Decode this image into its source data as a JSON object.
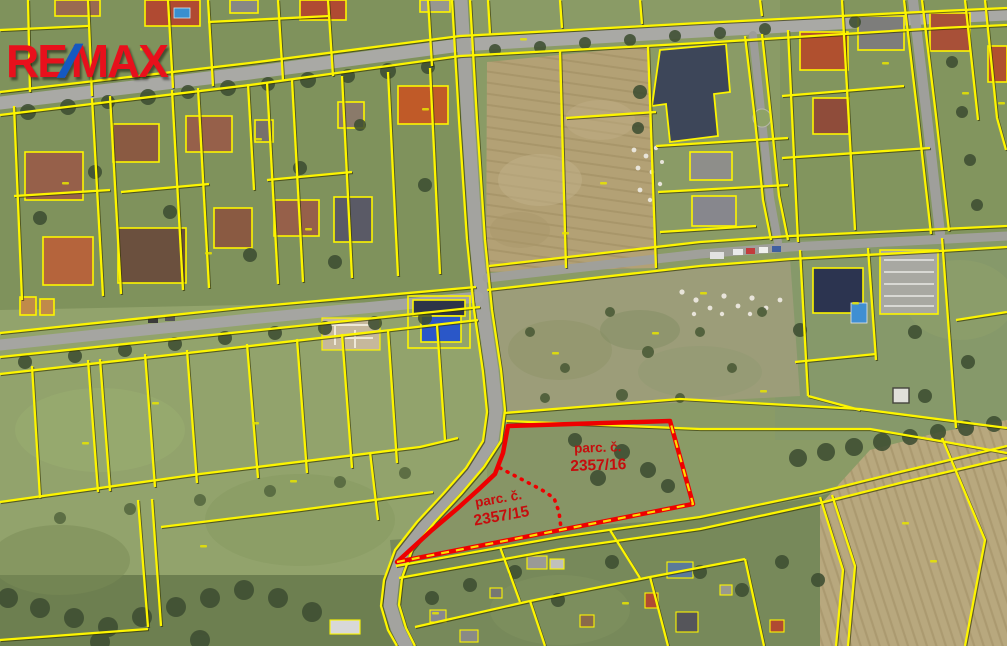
{
  "map": {
    "type": "aerial-cadastral-map",
    "watermark": {
      "part1": "RE",
      "slash": "/",
      "part2": "MAX"
    },
    "highlighted_parcels": [
      {
        "id": "2357/16",
        "label_line1": "parc. č.",
        "label_line2": "2357/16"
      },
      {
        "id": "2357/15",
        "label_line1": "parc. č.",
        "label_line2": "2357/15"
      }
    ],
    "colors": {
      "parcel_boundary": "#fdf500",
      "highlight_boundary": "#ee0000",
      "parcel_label_text": "#c60d0d",
      "logo_red": "#e8101c",
      "logo_blue": "#1559c0"
    }
  }
}
